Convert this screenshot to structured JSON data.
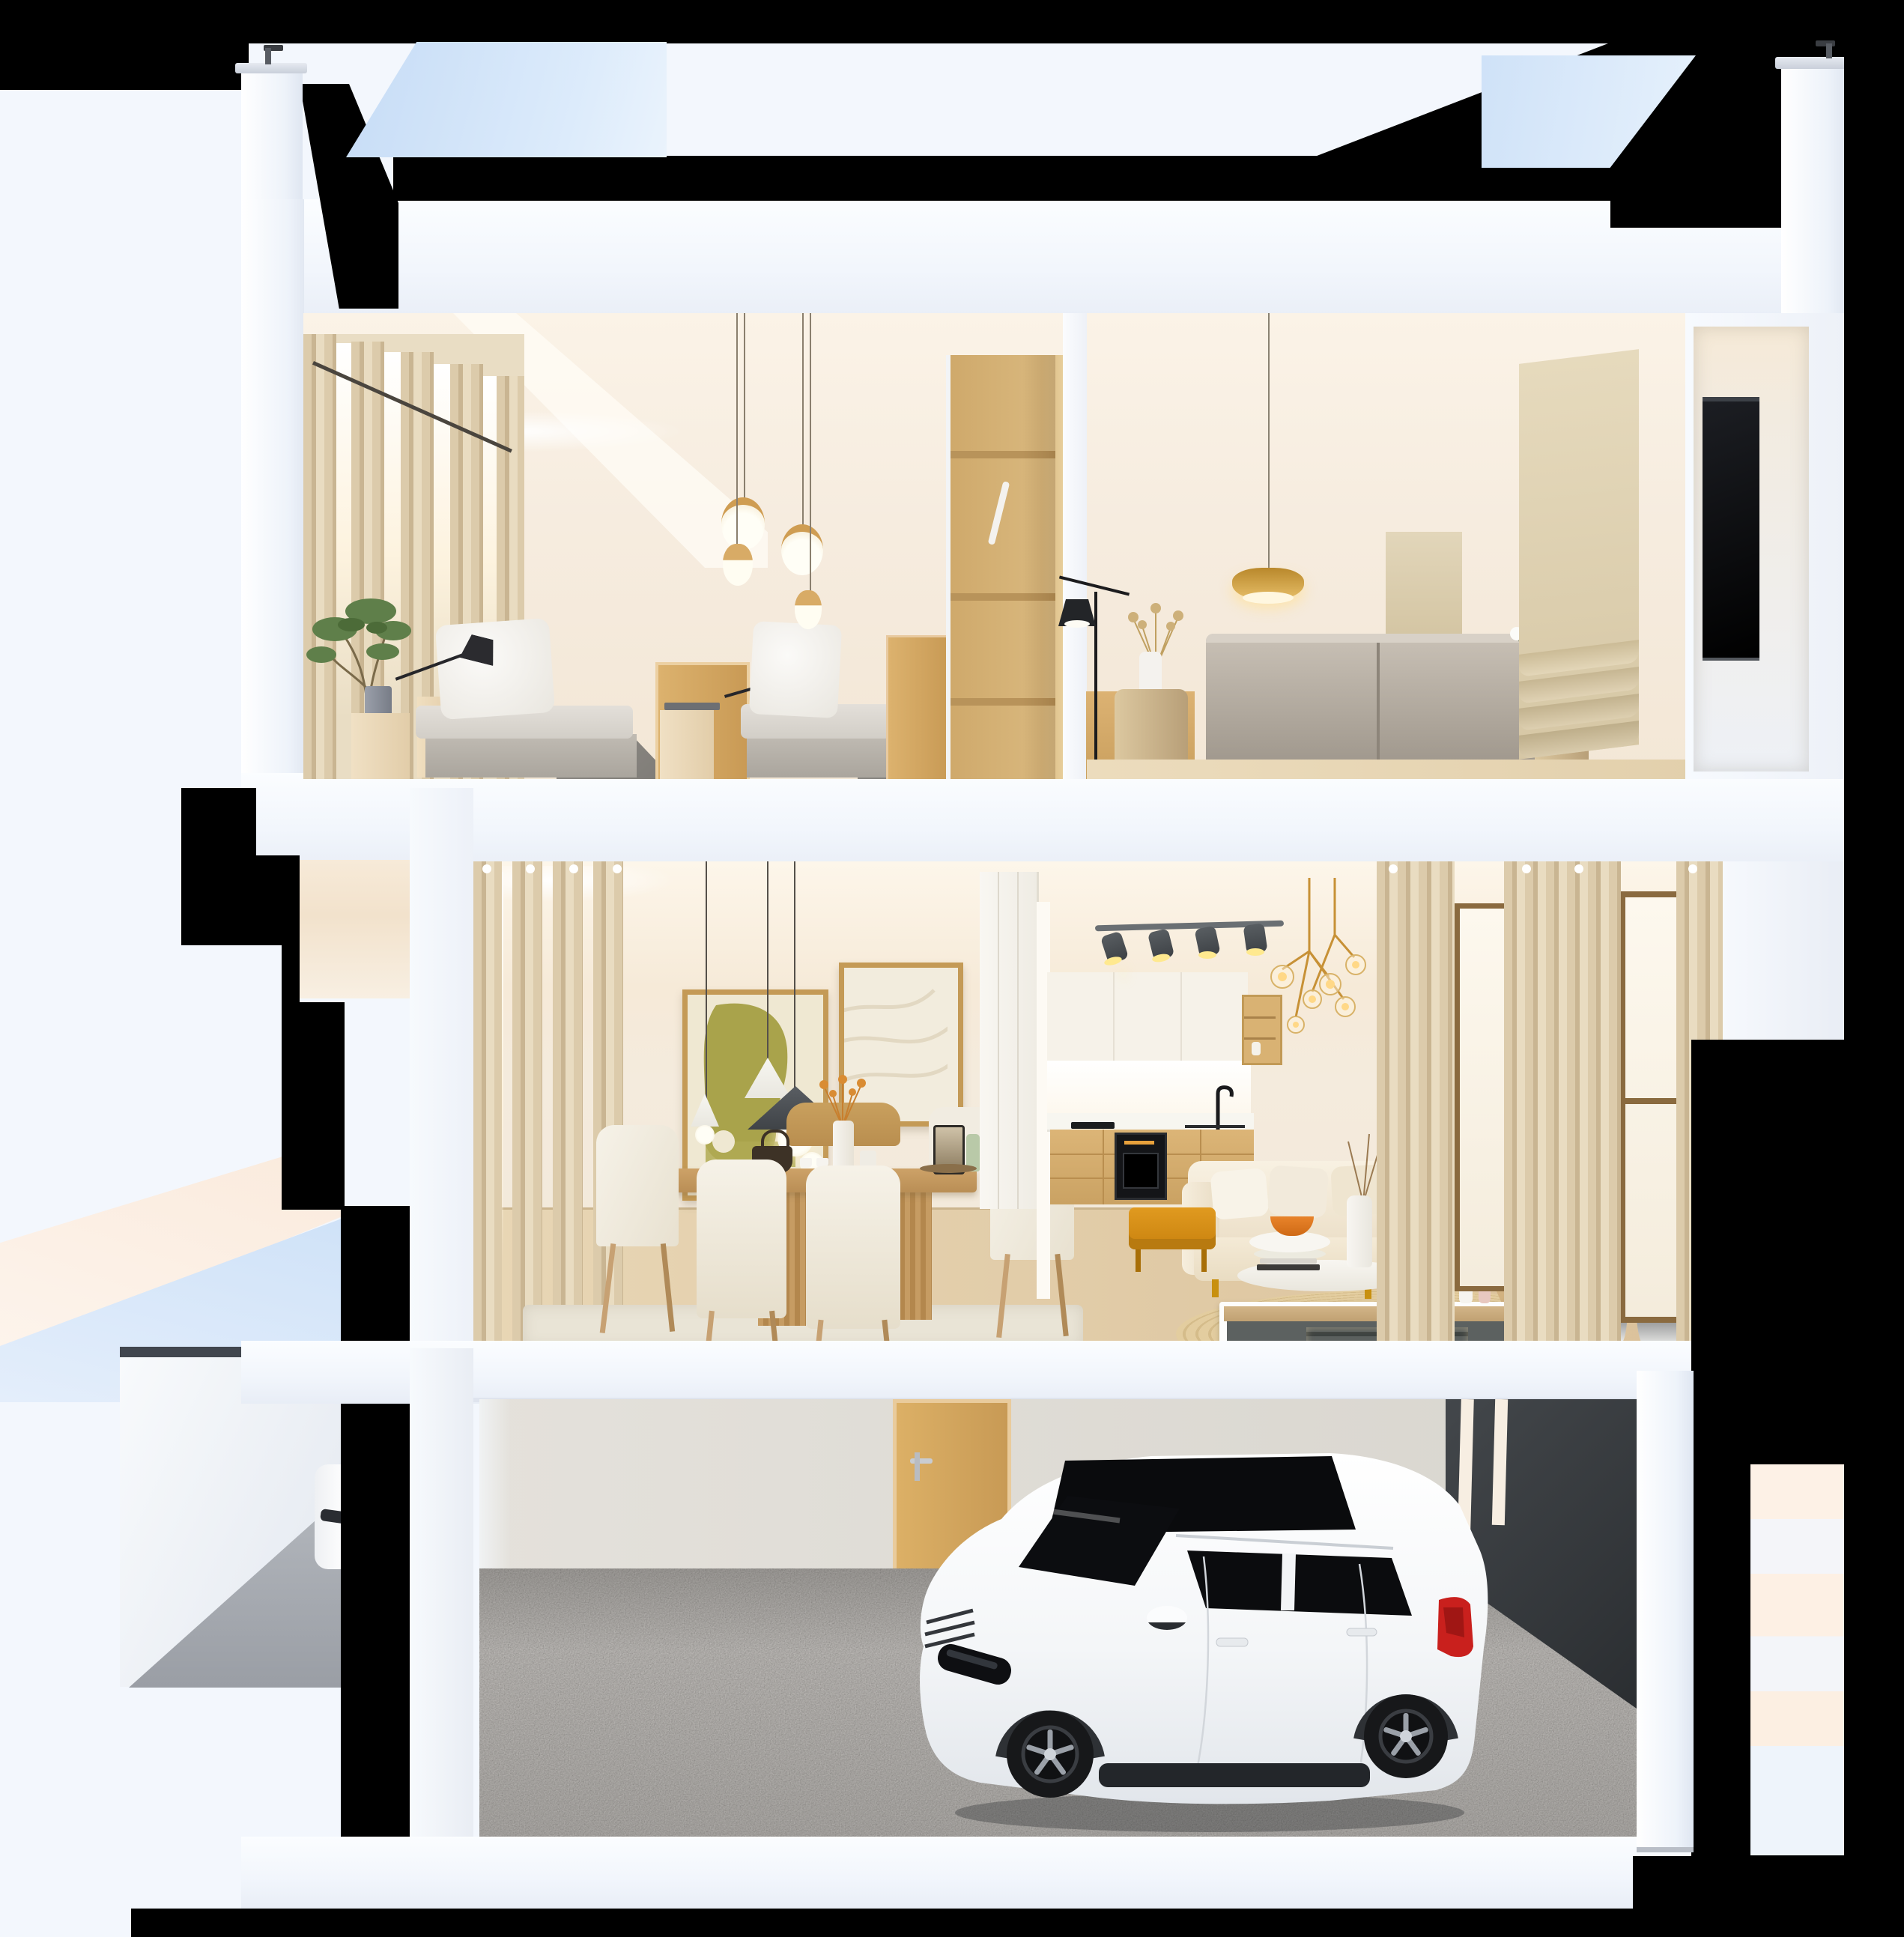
{
  "meta": {
    "description": "Photoreal 3D cutaway cross-section render of a three-storey house (dollhouse section view)",
    "view": "front section elevation, slightly elevated camera",
    "floors_count": 3
  },
  "palette": {
    "bg": "#f3f7fd",
    "structure_black": "#000000",
    "sky_blue": "#cfe2f8",
    "sky_blue_light": "#e2eefb",
    "slab_white": "#f8fafd",
    "warm_wall": "#f6ecdf",
    "warm_ceiling": "#fbf3e7",
    "glow": "#fff8ea",
    "curtain": "#dccbab",
    "curtain_light": "#e9dcc1",
    "curtain_dark": "#c9b592",
    "wood_oak": "#d3a964",
    "wood_ply": "#d9b87e",
    "wood_floor": "#e8d6b5",
    "wood_floor_dark": "#d9bf97",
    "bed_gray": "#b7b2aa",
    "mattress": "#dcd8d1",
    "pillow_white": "#f7f5f1",
    "sofa_gray": "#b4aca1",
    "shade_beige": "#ddd0b2",
    "tv_black": "#0d0d0f",
    "art_olive": "#a8a24a",
    "frame_gold": "#c49a56",
    "cone_charcoal": "#4a4e52",
    "table_wood": "#c49a62",
    "chair_cream": "#f1ece1",
    "cab_white": "#f6f2e9",
    "cab_wood": "#d5ae6e",
    "oven_black": "#141518",
    "gold": "#c79136",
    "glow_warm": "#ffd887",
    "sofa_cream": "#f3ead8",
    "mustard": "#d28f1d",
    "console_gray": "#5c6160",
    "rug_round": "#e0c9a0",
    "rug_dining": "#e9e4d6",
    "garage_wall": "#dedbd4",
    "carpet_gray": "#97918a",
    "dark_wall": "#3b3f43",
    "car_white": "#f7f8f9",
    "car_glass": "#0b0c0e",
    "taillight_red": "#c9201d",
    "wheel_black": "#17181a",
    "spoke_silver": "#9aa0a8"
  },
  "scene": {
    "exterior": {
      "roof_frame": "black cut-outline and shadow gaps",
      "sky_patches": [
        "upper-left reflection",
        "upper-right reflection"
      ],
      "columns": [
        "left parapet column with cap",
        "right parapet column with cap"
      ],
      "base": "black ground shadow bar"
    },
    "floors": [
      {
        "name": "top-floor",
        "rooms": [
          {
            "name": "twin-bedroom",
            "items": [
              "sheer beige curtains",
              "potted green tree",
              "two single beds with white pillows",
              "black swing-arm wall lamps",
              "four wood-capped glowing pendants",
              "oak door",
              "tall oak panel",
              "open plywood wardrobe with hanger rail"
            ]
          },
          {
            "name": "tv-lounge",
            "items": [
              "brass dish pendant",
              "two black floor lamps",
              "log side tables",
              "dried bouquet in white vase",
              "white orchid",
              "gray fabric sofa",
              "linen roman shades",
              "dark TV panel in right niche"
            ]
          }
        ]
      },
      {
        "name": "middle-floor",
        "rooms": [
          {
            "name": "dining-area",
            "items": [
              "pleated beige curtains with lit window slits",
              "olive abstract artwork in gold frame",
              "white relief artwork in gold frame",
              "cone pendant cluster with glass globes",
              "oak dining table on fluted pedestals",
              "cream dining chairs",
              "dark teapot and cups",
              "vase with amber dried flowers",
              "french press",
              "green bottle"
            ]
          },
          {
            "name": "kitchen",
            "items": [
              "white upper cabinets",
              "lit backsplash",
              "terrazzo counter",
              "oak base cabinets",
              "built-in black oven",
              "black cooktop",
              "black faucet",
              "track spotlights",
              "brass globe chandelier",
              "oak open shelves"
            ]
          },
          {
            "name": "living-area",
            "items": [
              "cream L-shaped sofa with pillows",
              "tan throw blanket",
              "amber ottoman bench",
              "two white round coffee tables",
              "orange bowl",
              "books",
              "round jute rug",
              "white-framed slatted media console",
              "two bonsai trees in ink-wash pots",
              "tall curtains with bronze framed windows"
            ]
          }
        ]
      },
      {
        "name": "garage",
        "items": [
          "white compact SUV with black glass roof",
          "gray carpet floor",
          "oak service door with steel handle",
          "charcoal garage wall with lit slits",
          "white pier",
          "warm-lit side wall strip"
        ]
      }
    ],
    "neighbor_unit": {
      "items": [
        "stepped black cut shadows",
        "peach and sky-blue reflection triangles",
        "second garage niche",
        "partial white car"
      ]
    }
  }
}
